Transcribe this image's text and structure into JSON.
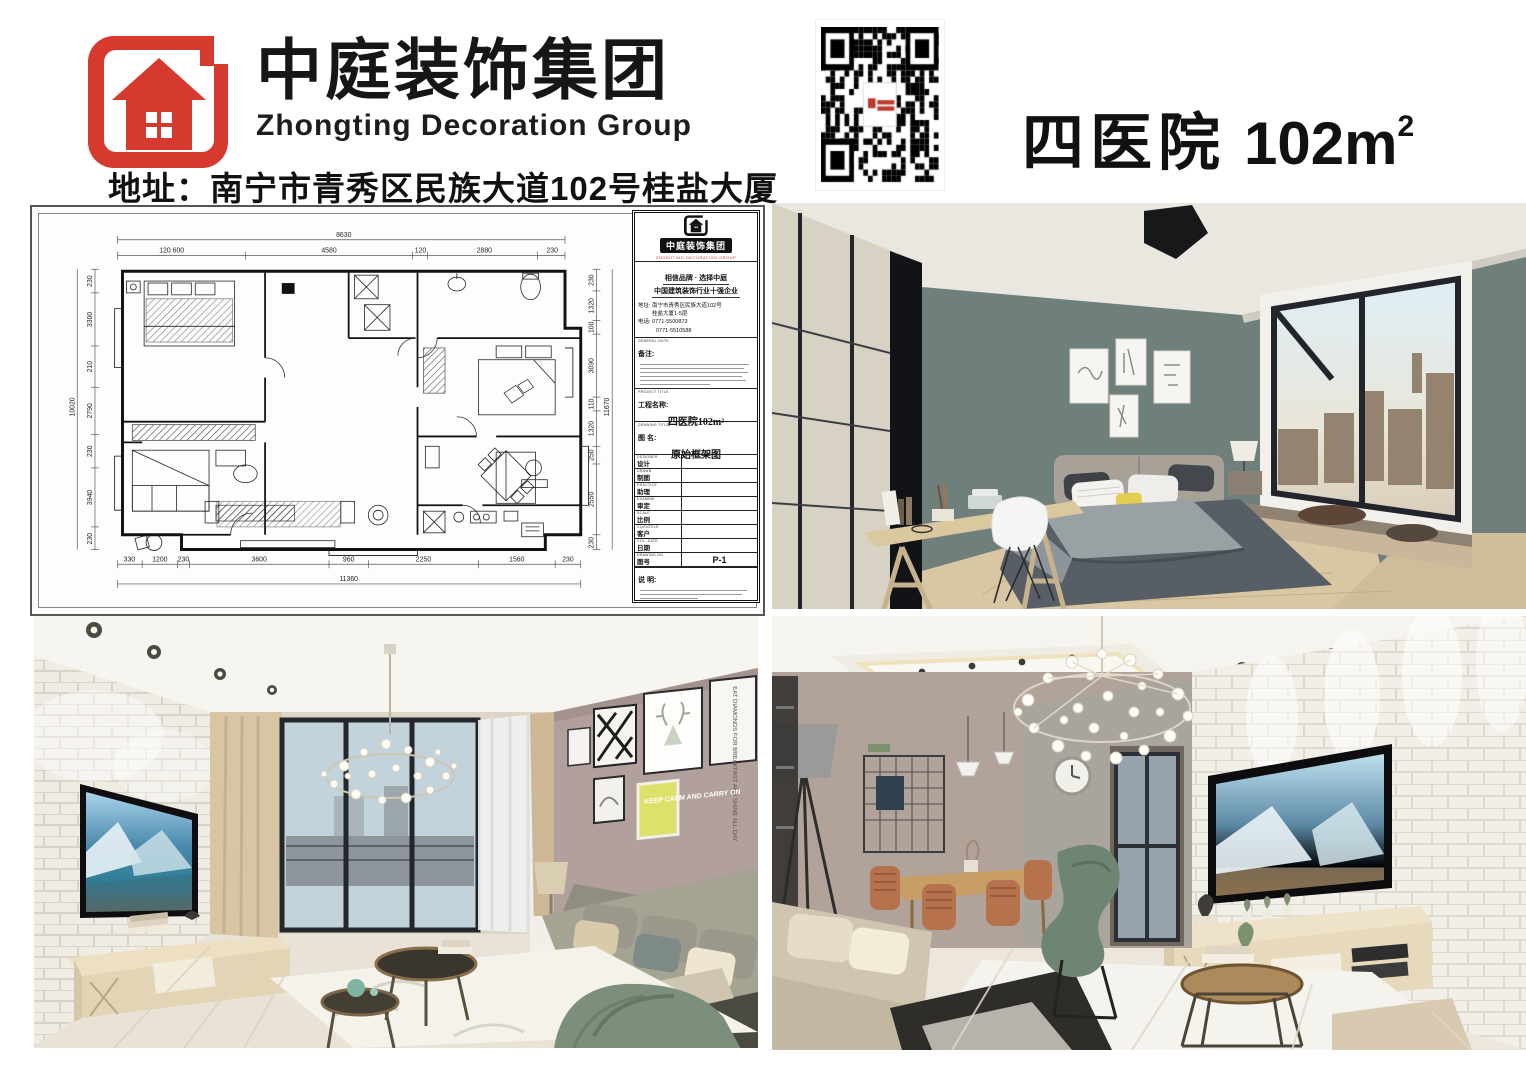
{
  "header": {
    "brand_cn": "中庭装饰集团",
    "brand_en": "Zhongting Decoration Group",
    "address": "地址：南宁市青秀区民族大道102号桂盐大厦",
    "qr_label": "wechat-qr-code",
    "project_name": "四医院",
    "project_area": "102m",
    "project_area_sup": "2"
  },
  "floorplan": {
    "titleblock": {
      "logo_cn": "中庭装饰集团",
      "logo_sub": "ZHONGTING DECORATION GROUP",
      "slogan1": "相信品牌 · 选择中庭",
      "slogan2": "中国建筑装饰行业十强企业",
      "addr_line1": "地址: 南宁市青秀区民族大道102号",
      "addr_line2": "桂盐大厦1-5层",
      "tel_line1": "电话: 0771-5500873",
      "tel_line2": "0771-5510588",
      "note_en": "GENERAL NOTE",
      "note_label": "备注:",
      "project_title_en": "PROJECT TITLE",
      "project_title_label": "工程名称:",
      "project_title_value": "四医院102m²",
      "drawing_title_en": "DRAWING TITLE",
      "drawing_title_label": "图  名:",
      "drawing_title_value": "原始框架图",
      "rows": [
        {
          "en": "DESIGNER",
          "cn": "设计",
          "value": ""
        },
        {
          "en": "DRAWN",
          "cn": "制图",
          "value": ""
        },
        {
          "en": "PRACTICE",
          "cn": "助理",
          "value": ""
        },
        {
          "en": "EXAMINE",
          "cn": "审定",
          "value": ""
        },
        {
          "en": "SCALE",
          "cn": "比例",
          "value": ""
        },
        {
          "en": "CLIENTELE",
          "cn": "客户",
          "value": ""
        },
        {
          "en": "COL. DATE",
          "cn": "日期",
          "value": ""
        },
        {
          "en": "DRAWING NO",
          "cn": "图号",
          "value": "P-1"
        }
      ],
      "remark_label": "说  明:"
    },
    "dims": {
      "top_total": "8630",
      "top": [
        "120 600",
        "4580",
        "120",
        "2880",
        "230"
      ],
      "bottom": [
        "330",
        "1200",
        "230",
        "3600",
        "960",
        "2250",
        "1560",
        "230"
      ],
      "bottom_total": "11360",
      "left": [
        "230",
        "3300",
        "210",
        "2790",
        "230",
        "3940",
        "230"
      ],
      "left_total": "10020",
      "right": [
        "230",
        "1320",
        "100",
        "3090",
        "110",
        "1320",
        "250",
        "2550",
        "230"
      ],
      "right_total": "11670"
    }
  },
  "photos": {
    "living1": {
      "art_quote": "EAT DIAMONDS FOR BREAKFAST AND SHINE ALL DAY",
      "art_keepcalm": "KEEP CALM AND CARRY ON"
    }
  }
}
